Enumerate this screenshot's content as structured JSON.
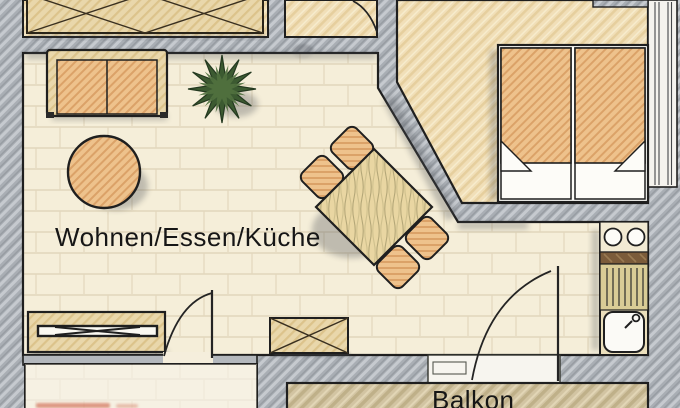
{
  "plan": {
    "type": "apartment-floor-plan",
    "labels": {
      "living_room": "Wohnen/Essen/Küche",
      "balcony": "Balkon"
    },
    "palette": {
      "wall_gray": "#a9aeb4",
      "wall_hatch": "#c6cacf",
      "floor_cream": "#f5eed9",
      "floor_tan": "#f0dfb8",
      "balcony_tan": "#d2c4a2",
      "furniture_orange": "#ecbd85",
      "furniture_orange_hatch": "#dba268",
      "wood_tan": "#e8d6ab",
      "table_grain": "#b4a778",
      "plant_green": "#3c5a31",
      "outline_ink": "#1f1f1f",
      "cropped_red_fragment": "#c84e32"
    },
    "furniture_icons": [
      "wardrobe-icon",
      "sofa-icon",
      "coffee-table-icon",
      "plant-icon",
      "dining-table-icon",
      "chair-icon",
      "double-bed-icon",
      "pillow-icon",
      "tv-sideboard-icon",
      "chest-icon",
      "cooktop-icon",
      "sink-drainer-icon",
      "door-swing-icon",
      "window-icon"
    ]
  }
}
